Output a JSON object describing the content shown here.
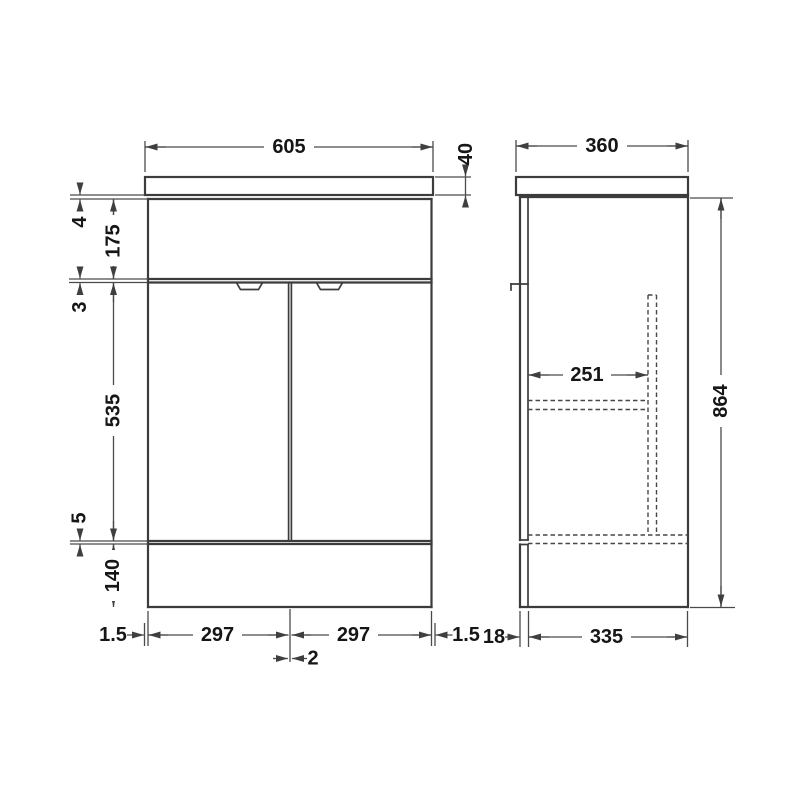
{
  "front_view": {
    "top_width": "605",
    "basin_thickness": "40",
    "basin_gap": "4",
    "top_rail_height": "175",
    "door_top_gap": "3",
    "door_height": "535",
    "door_bottom_gap": "5",
    "plinth_height": "140",
    "left_inset": "1.5",
    "left_door_width": "297",
    "door_center_gap": "2",
    "right_door_width": "297",
    "right_inset": "1.5"
  },
  "side_view": {
    "top_depth": "360",
    "overall_height": "864",
    "shelf_depth": "251",
    "door_thickness": "18",
    "carcass_depth": "335"
  }
}
